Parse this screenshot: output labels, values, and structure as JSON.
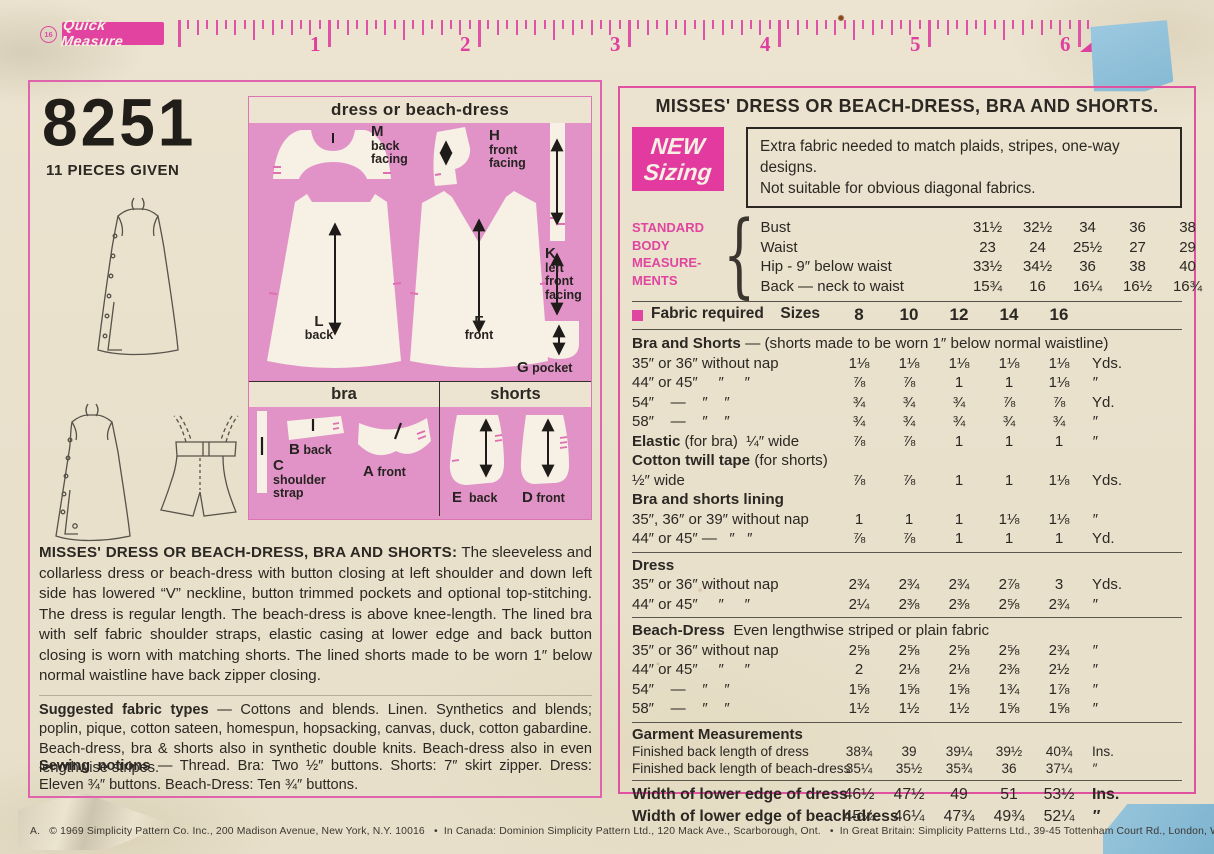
{
  "colors": {
    "paper": "#e9e1cc",
    "accent_pink": "#e0449f",
    "diagram_pink": "#e193c8",
    "tape_blue": "#92c3db",
    "ink": "#2b2723"
  },
  "ruler": {
    "badge": "16",
    "brand": "Quick Measure",
    "numbers": [
      "1",
      "2",
      "3",
      "4",
      "5",
      "6"
    ]
  },
  "left_panel": {
    "pattern_number": "8251",
    "pieces_given": "11 PIECES GIVEN",
    "diagram": {
      "dress_title": "dress or beach-dress",
      "bra_title": "bra",
      "shorts_title": "shorts",
      "pieces": {
        "m": {
          "id": "M",
          "label": "back\nfacing"
        },
        "h": {
          "id": "H",
          "label": "front\nfacing"
        },
        "k": {
          "id": "K",
          "label": "left\nfront\nfacing"
        },
        "l": {
          "id": "L",
          "label": "back"
        },
        "f": {
          "id": "F",
          "label": "front"
        },
        "g": {
          "id": "G",
          "label": "pocket"
        },
        "c": {
          "id": "C",
          "label": "shoulder\nstrap"
        },
        "b": {
          "id": "B",
          "label": "back"
        },
        "a": {
          "id": "A",
          "label": "front"
        },
        "e": {
          "id": "E",
          "label": "back"
        },
        "d": {
          "id": "D",
          "label": "front"
        }
      }
    },
    "description_title": "MISSES' DRESS OR BEACH-DRESS, BRA AND SHORTS:",
    "description": "The sleeveless and collarless dress or beach-dress with button closing at left shoulder and down left side has lowered “V” neckline, button trimmed pockets and optional top-stitching. The dress is regular length. The beach-dress is above knee-length. The lined bra with self fabric shoulder straps, elastic casing at lower edge and back button closing is worn with matching shorts. The lined shorts made to be worn 1″ below normal waistline have back zipper closing.",
    "fabric_types_title": "Suggested fabric types",
    "fabric_types": "— Cottons and blends. Linen. Synthetics and blends; poplin, pique, cotton sateen, homespun, hopsacking, canvas, duck, cotton gabardine. Beach-dress, bra & shorts also in synthetic double knits. Beach-dress also in even lengthwise stripes.",
    "notions_title": "Sewing notions",
    "notions": "— Thread. Bra: Two ½″ buttons. Shorts: 7″ skirt zipper. Dress: Eleven ¾″ buttons. Beach-Dress: Ten ¾″ buttons."
  },
  "right_panel": {
    "title": "MISSES' DRESS OR BEACH-DRESS, BRA AND SHORTS.",
    "new_sizing_line1": "NEW",
    "new_sizing_line2": "Sizing",
    "notice_line1": "Extra fabric needed to match plaids, stripes, one-way designs.",
    "notice_line2": "Not suitable for obvious diagonal fabrics.",
    "body_measurements": {
      "label_lines": [
        "STANDARD",
        "BODY",
        "MEASURE-",
        "MENTS"
      ],
      "rows": [
        {
          "label": "Bust",
          "values": [
            "31½",
            "32½",
            "34",
            "36",
            "38"
          ],
          "unit": "Ins."
        },
        {
          "label": "Waist",
          "values": [
            "23",
            "24",
            "25½",
            "27",
            "29"
          ],
          "unit": "″"
        },
        {
          "label": "Hip - 9″ below waist",
          "values": [
            "33½",
            "34½",
            "36",
            "38",
            "40"
          ],
          "unit": "″"
        },
        {
          "label": "Back — neck to waist",
          "values": [
            "15¾",
            "16",
            "16¼",
            "16½",
            "16¾"
          ],
          "unit": "″"
        }
      ]
    },
    "fabric_header": {
      "label": "Fabric required",
      "sizes_label": "Sizes",
      "sizes": [
        "8",
        "10",
        "12",
        "14",
        "16"
      ]
    },
    "sections": [
      {
        "heading_bold": "Bra and Shorts",
        "heading_rest": " — (shorts made to be worn 1″ below normal waistline)",
        "rows": [
          {
            "label": "35″ or 36″ without nap",
            "values": [
              "1⅛",
              "1⅛",
              "1⅛",
              "1⅛",
              "1⅛"
            ],
            "unit": "Yds."
          },
          {
            "label": "44″ or 45″     ″     ″",
            "values": [
              "⅞",
              "⅞",
              "1",
              "1",
              "1⅛"
            ],
            "unit": "″"
          },
          {
            "label": "54″    —    ″    ″",
            "values": [
              "¾",
              "¾",
              "¾",
              "⅞",
              "⅞"
            ],
            "unit": "Yd."
          },
          {
            "label": "58″    —    ″    ″",
            "values": [
              "¾",
              "¾",
              "¾",
              "¾",
              "¾"
            ],
            "unit": "″"
          }
        ]
      },
      {
        "rows": [
          {
            "label_bold": "Elastic",
            "label": " (for bra)  ¼″ wide",
            "values": [
              "⅞",
              "⅞",
              "1",
              "1",
              "1"
            ],
            "unit": "″"
          }
        ]
      },
      {
        "heading_bold": "Cotton twill tape",
        "heading_rest": " (for shorts)",
        "rows": [
          {
            "label": "½″ wide",
            "values": [
              "⅞",
              "⅞",
              "1",
              "1",
              "1⅛"
            ],
            "unit": "Yds."
          }
        ]
      },
      {
        "heading_bold": "Bra and shorts lining",
        "rows": [
          {
            "label": "35″, 36″ or 39″ without nap",
            "values": [
              "1",
              "1",
              "1",
              "1⅛",
              "1⅛"
            ],
            "unit": "″"
          },
          {
            "label": "44″ or 45″ —   ″   ″",
            "values": [
              "⅞",
              "⅞",
              "1",
              "1",
              "1"
            ],
            "unit": "Yd."
          }
        ]
      },
      {
        "rule": true,
        "heading_bold": "Dress",
        "rows": [
          {
            "label": "35″ or 36″ without nap",
            "values": [
              "2¾",
              "2¾",
              "2¾",
              "2⅞",
              "3"
            ],
            "unit": "Yds."
          },
          {
            "label": "44″ or 45″     ″     ″",
            "values": [
              "2¼",
              "2⅜",
              "2⅜",
              "2⅝",
              "2¾"
            ],
            "unit": "″"
          }
        ]
      },
      {
        "rule": true,
        "heading_bold": "Beach-Dress",
        "heading_rest": "  Even lengthwise striped or plain fabric",
        "rows": [
          {
            "label": "35″ or 36″ without nap",
            "values": [
              "2⅝",
              "2⅝",
              "2⅝",
              "2⅝",
              "2¾"
            ],
            "unit": "″"
          },
          {
            "label": "44″ or 45″     ″     ″",
            "values": [
              "2",
              "2⅛",
              "2⅛",
              "2⅜",
              "2½"
            ],
            "unit": "″"
          },
          {
            "label": "54″    —    ″    ″",
            "values": [
              "1⅝",
              "1⅝",
              "1⅝",
              "1¾",
              "1⅞"
            ],
            "unit": "″"
          },
          {
            "label": "58″    —    ″    ″",
            "values": [
              "1½",
              "1½",
              "1½",
              "1⅝",
              "1⅝"
            ],
            "unit": "″"
          }
        ]
      },
      {
        "rule": true,
        "heading_bold": "Garment Measurements",
        "cls": "small",
        "rows": [
          {
            "label": "Finished back length of dress",
            "values": [
              "38¾",
              "39",
              "39¼",
              "39½",
              "40¾"
            ],
            "unit": "Ins."
          },
          {
            "label": "Finished back length of beach-dress",
            "values": [
              "35¼",
              "35½",
              "35¾",
              "36",
              "37¼"
            ],
            "unit": "″"
          }
        ]
      },
      {
        "rule": true,
        "cls": "wide",
        "rows": [
          {
            "label_bold": "Width of lower edge of dress",
            "values": [
              "46½",
              "47½",
              "49",
              "51",
              "53½"
            ],
            "unit": "Ins."
          },
          {
            "label_bold": "Width of lower edge of beach-dress",
            "values": [
              "45¼",
              "46¼",
              "47¾",
              "49¾",
              "52¼"
            ],
            "unit": "″"
          }
        ]
      }
    ]
  },
  "footer": "A.   © 1969 Simplicity Pattern Co. Inc., 200 Madison Avenue, New York, N.Y. 10016   •  In Canada: Dominion Simplicity Pattern Ltd., 120 Mack Ave., Scarborough, Ont.   •  In Great Britain: Simplicity Patterns Ltd., 39-45 Tottenham Court Rd., London, W. 1., England."
}
